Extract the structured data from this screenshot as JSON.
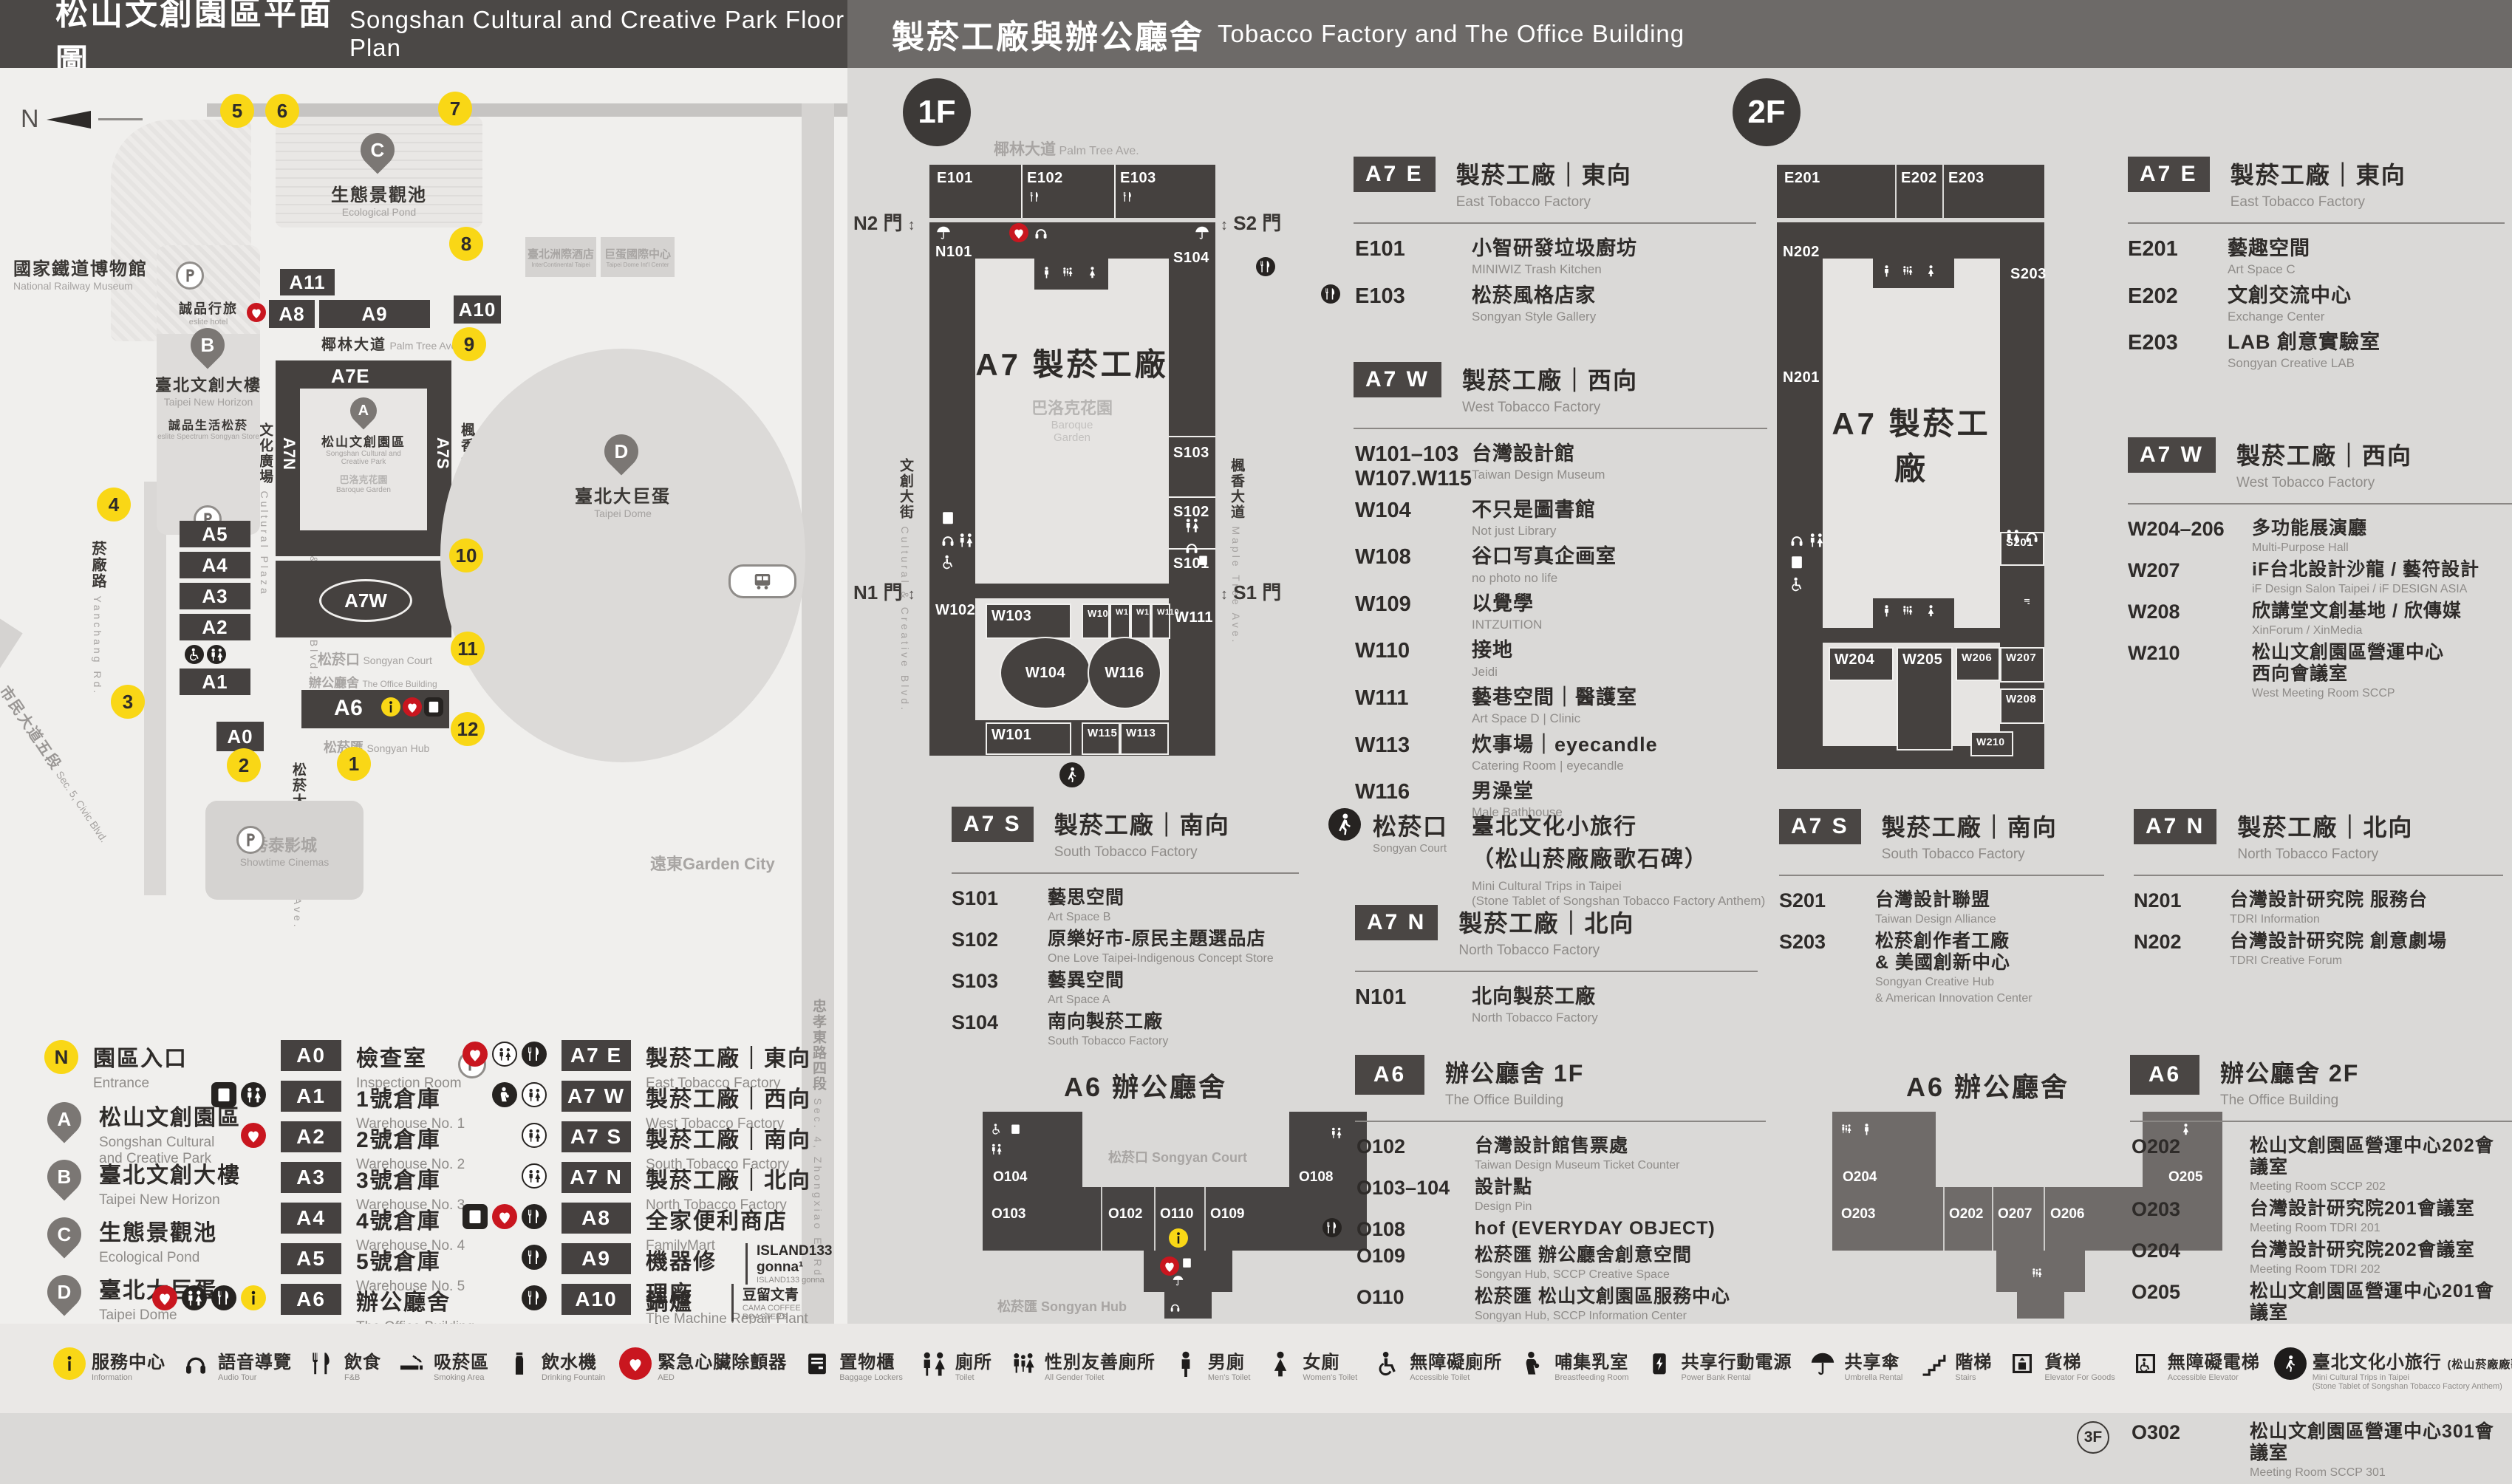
{
  "header": {
    "left": {
      "zh": "松山文創園區平面圖",
      "en": "Songshan Cultural and Creative Park Floor Plan"
    },
    "right": {
      "zh": "製菸工廠與辦公廳舍",
      "en": "Tobacco Factory and The Office Building"
    }
  },
  "colors": {
    "accent_yellow": "#f9d716",
    "accent_red": "#c9161f",
    "building_dark": "#45413f",
    "panel_gray": "#dad9d7"
  },
  "map": {
    "compass": "N",
    "entrances": [
      "1",
      "2",
      "3",
      "4",
      "5",
      "6",
      "7",
      "8",
      "9",
      "10",
      "11",
      "12"
    ],
    "buildings": {
      "a0": "A0",
      "a1": "A1",
      "a2": "A2",
      "a3": "A3",
      "a4": "A4",
      "a5": "A5",
      "a6": "A6",
      "a7e": "A7E",
      "a7n": "A7N",
      "a7s": "A7S",
      "a7w": "A7W",
      "a8": "A8",
      "a9": "A9",
      "a10": "A10",
      "a11": "A11"
    },
    "places": {
      "railway": {
        "zh": "國家鐵道博物館",
        "en": "National Railway Museum"
      },
      "esliteHotel": {
        "zh": "誠品行旅",
        "en": "eslite hotel"
      },
      "newHorizon": {
        "zh": "臺北文創大樓",
        "en": "Taipei New Horizon"
      },
      "esliteSpectrum": {
        "zh": "誠品生活松菸",
        "en": "eslite Spectrum Songyan Store"
      },
      "pond": {
        "zh": "生態景觀池",
        "en": "Ecological Pond"
      },
      "park": {
        "zh": "松山文創園區",
        "en1": "Songshan Cultural and",
        "en2": "Creative Park"
      },
      "baroque": {
        "zh": "巴洛克花園",
        "en": "Baroque Garden"
      },
      "dome": {
        "zh": "臺北大巨蛋",
        "en": "Taipei Dome"
      },
      "icHotel": {
        "zh": "臺北洲際酒店",
        "en": "InterContinental Taipei"
      },
      "domeCenter": {
        "zh": "巨蛋國際中心",
        "en": "Taipei Dome Int'l Center"
      },
      "showtime": {
        "zh": "秀泰影城",
        "en": "Showtime Cinemas"
      },
      "gardenCity": {
        "zh": "遠東Garden City"
      },
      "court": {
        "zh": "松菸口",
        "en": "Songyan Court"
      },
      "office": {
        "zh": "辦公廳舍",
        "en": "The Office Building"
      },
      "hub": {
        "zh": "松菸匯",
        "en": "Songyan Hub"
      }
    },
    "roads": {
      "palm": {
        "zh": "椰林大道",
        "en": "Palm Tree Ave."
      },
      "culturalPlaza": {
        "zh": "文化廣場",
        "en": "Cultural Plaza"
      },
      "creativeBlvd": {
        "zh": "文創大街",
        "en": "Cultural & Creative Blvd."
      },
      "maple": {
        "zh": "楓香大道",
        "en": "Maple Tree Ave."
      },
      "songyanAve": {
        "zh": "松菸大道",
        "en": "Songyan Ave."
      },
      "yanchang": {
        "zh": "菸廠路",
        "en": "Yanchang Rd."
      },
      "civic": {
        "zh": "市民大道五段",
        "en": "Sec. 5, Civic Blvd."
      },
      "zhongxiao": {
        "zh": "忠孝東路四段",
        "en": "Sec. 4, Zhongxiao E. Rd."
      }
    }
  },
  "legend": {
    "entrance": {
      "badge": "N",
      "zh": "園區入口",
      "en": "Entrance"
    },
    "pins": [
      {
        "badge": "A",
        "zh": "松山文創園區",
        "en": "Songshan Cultural\nand Creative Park"
      },
      {
        "badge": "B",
        "zh": "臺北文創大樓",
        "en": "Taipei New Horizon"
      },
      {
        "badge": "C",
        "zh": "生態景觀池",
        "en": "Ecological Pond"
      },
      {
        "badge": "D",
        "zh": "臺北大巨蛋",
        "en": "Taipei Dome"
      }
    ],
    "col2": [
      {
        "code": "A0",
        "zh": "檢查室",
        "en": "Inspection Room",
        "icons": []
      },
      {
        "code": "A1",
        "zh": "1號倉庫",
        "en": "Warehouse No. 1",
        "icons": [
          "locker-icon",
          "toilet-icon"
        ]
      },
      {
        "code": "A2",
        "zh": "2號倉庫",
        "en": "Warehouse No. 2",
        "icons": [
          "aed-icon"
        ]
      },
      {
        "code": "A3",
        "zh": "3號倉庫",
        "en": "Warehouse No. 3",
        "icons": []
      },
      {
        "code": "A4",
        "zh": "4號倉庫",
        "en": "Warehouse No. 4",
        "icons": []
      },
      {
        "code": "A5",
        "zh": "5號倉庫",
        "en": "Warehouse No. 5",
        "icons": []
      },
      {
        "code": "A6",
        "zh": "辦公廳舍",
        "en": "The Office Building",
        "icons": [
          "aed-icon",
          "toilet-icon",
          "dining-icon",
          "info-icon"
        ]
      }
    ],
    "col3": [
      {
        "code": "A7 E",
        "zh": "製菸工廠｜東向",
        "en": "East Tobacco Factory",
        "icons": [
          "aed-icon",
          "toilet-icon",
          "dining-icon"
        ]
      },
      {
        "code": "A7 W",
        "zh": "製菸工廠｜西向",
        "en": "West Tobacco Factory",
        "icons": [
          "breastfeeding-icon",
          "toilet-icon"
        ]
      },
      {
        "code": "A7 S",
        "zh": "製菸工廠｜南向",
        "en": "South Tobacco Factory",
        "icons": [
          "toilet-icon"
        ]
      },
      {
        "code": "A7 N",
        "zh": "製菸工廠｜北向",
        "en": "North Tobacco Factory",
        "icons": [
          "toilet-icon"
        ]
      },
      {
        "code": "A8",
        "zh": "全家便利商店",
        "en": "FamilyMart",
        "icons": [
          "locker-icon",
          "aed-icon",
          "dining-icon"
        ]
      },
      {
        "code": "A9",
        "zh": "機器修理廠",
        "en": "The Machine Repair Plant",
        "icons": [
          "dining-icon"
        ],
        "brand": "ISLAND133 gonna¹",
        "brand_en": "ISLAND133 gonna"
      },
      {
        "code": "A10",
        "zh": "鍋爐房",
        "en": "Boiler Room",
        "icons": [
          "dining-icon"
        ],
        "brand": "豆留文青",
        "brand_en": "CAMA COFFEE ROASTERS"
      },
      {
        "code": "A11",
        "zh": "育嬰室",
        "en": "The Nursery Room",
        "icons": [
          "dining-icon"
        ],
        "brand": "光一 一個時間",
        "brand_en": "GUANG YI IN TIME"
      }
    ]
  },
  "floor1": {
    "badge": "1F",
    "roads": {
      "palm": {
        "zh": "椰林大道",
        "en": "Palm Tree Ave."
      },
      "creative": {
        "zh": "文創大街",
        "en": "Cultural & Creative Blvd."
      },
      "maple": {
        "zh": "楓香大道",
        "en": "Maple Tree Ave."
      }
    },
    "gates": {
      "n2": "N2 門",
      "s2": "S2 門",
      "n1": "N1 門",
      "s1": "S1 門"
    },
    "plan": {
      "center": "A7 製菸工廠",
      "garden_zh": "巴洛克花園",
      "garden_en1": "Baroque",
      "garden_en2": "Garden",
      "rooms": {
        "E101": "E101",
        "E102": "E102",
        "E103": "E103",
        "N101": "N101",
        "S101": "S101",
        "S102": "S102",
        "S103": "S103",
        "S104": "S104",
        "W101": "W101",
        "W102": "W102",
        "W103": "W103",
        "W104": "W104",
        "W107": "W107",
        "W108": "W108",
        "W109": "W109",
        "W110": "W110",
        "W111": "W111",
        "W113": "W113",
        "W115": "W115",
        "W116": "W116"
      }
    },
    "a7e": {
      "badge": "A7 E",
      "zh": "製菸工廠｜東向",
      "en": "East Tobacco Factory",
      "rows": [
        {
          "code": "E101",
          "zh": "小智研發垃圾廚坊",
          "en": "MINIWIZ Trash Kitchen"
        },
        {
          "code": "E103",
          "zh": "松菸風格店家",
          "en": "Songyan Style Gallery",
          "icon": "dining-icon"
        }
      ]
    },
    "a7w": {
      "badge": "A7 W",
      "zh": "製菸工廠｜西向",
      "en": "West Tobacco Factory",
      "rows": [
        {
          "code": "W101–103",
          "code2": "W107.W115",
          "zh": "台灣設計館",
          "en": "Taiwan Design Museum"
        },
        {
          "code": "W104",
          "zh": "不只是圖書館",
          "en": "Not just Library"
        },
        {
          "code": "W108",
          "zh": "谷口写真企画室",
          "en": "no photo no life"
        },
        {
          "code": "W109",
          "zh": "以覺學",
          "en": "INTZUITION"
        },
        {
          "code": "W110",
          "zh": "接地",
          "en": "Jeidi"
        },
        {
          "code": "W111",
          "zh": "藝巷空間｜醫護室",
          "en": "Art Space D | Clinic"
        },
        {
          "code": "W113",
          "zh": "炊事場｜eyecandle",
          "en": "Catering Room | eyecandle"
        },
        {
          "code": "W116",
          "zh": "男澡堂",
          "en": "Male Bathhouse"
        }
      ]
    },
    "a7s": {
      "badge": "A7 S",
      "zh": "製菸工廠｜南向",
      "en": "South Tobacco Factory",
      "rows": [
        {
          "code": "S101",
          "zh": "藝思空間",
          "en": "Art Space B"
        },
        {
          "code": "S102",
          "zh": "原樂好市-原民主題選品店",
          "en": "One Love Taipei-Indigenous Concept Store"
        },
        {
          "code": "S103",
          "zh": "藝異空間",
          "en": "Art Space A"
        },
        {
          "code": "S104",
          "zh": "南向製菸工廠",
          "en": "South Tobacco Factory"
        }
      ]
    },
    "court": {
      "zh": "松菸口",
      "en": "Songyan Court",
      "line1": "臺北文化小旅行",
      "line2": "（松山菸廠廠歌石碑）",
      "en1": "Mini Cultural Trips in Taipei",
      "en2": "(Stone Tablet of Songshan Tobacco Factory Anthem)"
    },
    "a7n": {
      "badge": "A7 N",
      "zh": "製菸工廠｜北向",
      "en": "North Tobacco Factory",
      "rows": [
        {
          "code": "N101",
          "zh": "北向製菸工廠",
          "en": "North Tobacco Factory"
        }
      ]
    }
  },
  "floor2": {
    "badge": "2F",
    "plan": {
      "center": "A7 製菸工廠",
      "rooms": {
        "E201": "E201",
        "E202": "E202",
        "E203": "E203",
        "N201": "N201",
        "N202": "N202",
        "S201": "S201",
        "S203": "S203",
        "W204": "W204",
        "W205": "W205",
        "W206": "W206",
        "W207": "W207",
        "W208": "W208",
        "W210": "W210"
      }
    },
    "a7e": {
      "badge": "A7 E",
      "zh": "製菸工廠｜東向",
      "en": "East Tobacco Factory",
      "rows": [
        {
          "code": "E201",
          "zh": "藝趣空間",
          "en": "Art Space C"
        },
        {
          "code": "E202",
          "zh": "文創交流中心",
          "en": "Exchange Center"
        },
        {
          "code": "E203",
          "zh": "LAB 創意實驗室",
          "en": "Songyan Creative LAB"
        }
      ]
    },
    "a7w": {
      "badge": "A7 W",
      "zh": "製菸工廠｜西向",
      "en": "West Tobacco Factory",
      "rows": [
        {
          "code": "W204–206",
          "zh": "多功能展演廳",
          "en": "Multi-Purpose Hall"
        },
        {
          "code": "W207",
          "zh": "iF台北設計沙龍 / 藝符設計",
          "en": "iF Design Salon Taipei / iF DESIGN ASIA"
        },
        {
          "code": "W208",
          "zh": "欣講堂文創基地 / 欣傳媒",
          "en": "XinForum / XinMedia"
        },
        {
          "code": "W210",
          "zh": "松山文創園區營運中心",
          "zh2": "西向會議室",
          "en": "West Meeting Room SCCP"
        }
      ]
    },
    "a7s": {
      "badge": "A7 S",
      "zh": "製菸工廠｜南向",
      "en": "South Tobacco Factory",
      "rows": [
        {
          "code": "S201",
          "zh": "台灣設計聯盟",
          "en": "Taiwan Design Alliance"
        },
        {
          "code": "S203",
          "zh": "松菸創作者工廠",
          "zh2": "& 美國創新中心",
          "en": "Songyan Creative Hub",
          "en2": "& American Innovation Center"
        }
      ]
    },
    "a7n": {
      "badge": "A7 N",
      "zh": "製菸工廠｜北向",
      "en": "North Tobacco Factory",
      "rows": [
        {
          "code": "N201",
          "zh": "台灣設計研究院 服務台",
          "en": "TDRI Information"
        },
        {
          "code": "N202",
          "zh": "台灣設計研究院 創意劇場",
          "en": "TDRI Creative Forum"
        }
      ]
    }
  },
  "office1f": {
    "plan": {
      "title": "A6 辦公廳舍",
      "court": "松菸口 Songyan Court",
      "hub": "松菸匯 Songyan Hub",
      "rooms": {
        "O102": "O102",
        "O103": "O103",
        "O104": "O104",
        "O108": "O108",
        "O109": "O109",
        "O110": "O110"
      }
    },
    "badge": "A6",
    "zh": "辦公廳舍 1F",
    "en": "The Office Building",
    "rows": [
      {
        "code": "O102",
        "zh": "台灣設計館售票處",
        "en": "Taiwan Design Museum Ticket Counter"
      },
      {
        "code": "O103–104",
        "zh": "設計點",
        "en": "Design Pin"
      },
      {
        "code": "O108",
        "zh": "hof (EVERYDAY OBJECT)",
        "icon": "dining-icon"
      },
      {
        "code": "O109",
        "zh": "松菸匯 辦公廳舍創意空間",
        "en": "Songyan Hub, SCCP Creative Space"
      },
      {
        "code": "O110",
        "zh": "松菸匯 松山文創園區服務中心",
        "en": "Songyan Hub, SCCP Information Center"
      }
    ]
  },
  "office2f": {
    "plan": {
      "title": "A6 辦公廳舍",
      "rooms": {
        "O202": "O202",
        "O203": "O203",
        "O204": "O204",
        "O205": "O205",
        "O206": "O206",
        "O207": "O207"
      }
    },
    "badge": "A6",
    "zh": "辦公廳舍 2F",
    "en": "The Office Building",
    "rows": [
      {
        "code": "O202",
        "zh": "松山文創園區營運中心202會議室",
        "en": "Meeting Room SCCP 202"
      },
      {
        "code": "O203",
        "zh": "台灣設計研究院201會議室",
        "en": "Meeting Room TDRI 201"
      },
      {
        "code": "O204",
        "zh": "台灣設計研究院202會議室",
        "en": "Meeting Room TDRI 202"
      },
      {
        "code": "O205",
        "zh": "松山文創園區營運中心201會議室",
        "en": "Meeting Room SCCP 201"
      },
      {
        "code": "O206–207",
        "zh": "台北市文化基金會",
        "zh2": "松山文創園區營運中心",
        "en": "Taipei Culture Foundation SCCP Management Center"
      },
      {
        "prefix": "3F",
        "code": "O302",
        "zh": "松山文創園區營運中心301會議室",
        "en": "Meeting Room SCCP 301"
      }
    ]
  },
  "footer": [
    {
      "icon": "info-icon",
      "badge": "yellow",
      "zh": "服務中心",
      "en": "Information"
    },
    {
      "icon": "audio-tour-icon",
      "zh": "語音導覽",
      "en": "Audio Tour"
    },
    {
      "icon": "dining-icon",
      "zh": "飲食",
      "en": "F&B"
    },
    {
      "icon": "smoking-icon",
      "zh": "吸菸區",
      "en": "Smoking Area"
    },
    {
      "icon": "drinking-fountain-icon",
      "zh": "飲水機",
      "en": "Drinking Fountain"
    },
    {
      "icon": "aed-icon",
      "badge": "red",
      "zh": "緊急心臟除顫器",
      "en": "AED"
    },
    {
      "icon": "locker-icon",
      "zh": "置物櫃",
      "en": "Baggage Lockers"
    },
    {
      "icon": "toilet-icon",
      "zh": "廁所",
      "en": "Toilet"
    },
    {
      "icon": "all-gender-toilet-icon",
      "zh": "性別友善廁所",
      "en": "All Gender Toilet"
    },
    {
      "icon": "mens-toilet-icon",
      "zh": "男廁",
      "en": "Men's Toilet"
    },
    {
      "icon": "womens-toilet-icon",
      "zh": "女廁",
      "en": "Women's Toilet"
    },
    {
      "icon": "accessible-toilet-icon",
      "zh": "無障礙廁所",
      "en": "Accessible Toilet"
    },
    {
      "icon": "breastfeeding-icon",
      "zh": "哺集乳室",
      "en": "Breastfeeding Room"
    },
    {
      "icon": "power-bank-icon",
      "zh": "共享行動電源",
      "en": "Power Bank Rental"
    },
    {
      "icon": "umbrella-icon",
      "zh": "共享傘",
      "en": "Umbrella Rental"
    },
    {
      "icon": "stairs-icon",
      "zh": "階梯",
      "en": "Stairs"
    },
    {
      "icon": "goods-elevator-icon",
      "zh": "貨梯",
      "en": "Elevator For Goods"
    },
    {
      "icon": "accessible-elevator-icon",
      "zh": "無障礙電梯",
      "en": "Accessible Elevator"
    },
    {
      "icon": "cultural-trips-icon",
      "badge": "black",
      "zh": "臺北文化小旅行",
      "zh2": "(松山菸廠廠歌石碑)",
      "en": "Mini Cultural Trips in Taipei",
      "en2": "(Stone Tablet of Songshan Tobacco Factory Anthem)"
    }
  ]
}
